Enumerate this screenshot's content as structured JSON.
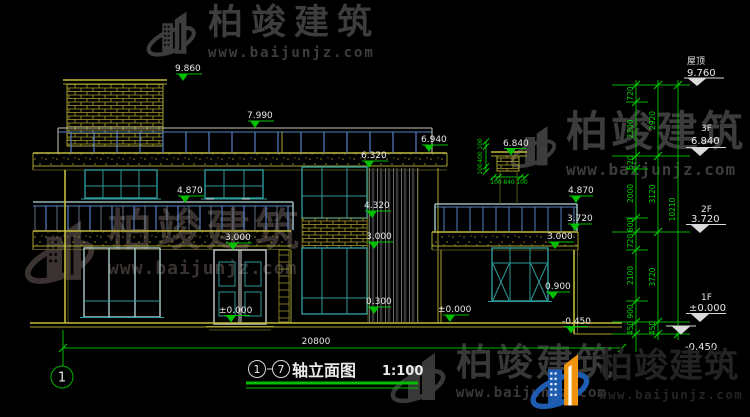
{
  "brand": {
    "name": "柏竣建筑",
    "url": "www.baijunjz.com"
  },
  "title": {
    "bubble_left": "1",
    "bubble_right": "7",
    "name": "轴立面图",
    "scale": "1:100"
  },
  "axis": {
    "bubble": "1"
  },
  "dims": {
    "v9860": "9.860",
    "v7990": "7.990",
    "v6940": "6.940",
    "v6320": "6.320",
    "v6840": "6.840",
    "v4870": "4.870",
    "v4320": "4.320",
    "v3720": "3.720",
    "v3000": "3.000",
    "v0900": "0.900",
    "v0300": "0.300",
    "vzero": "±0.000",
    "vneg": "-0.450",
    "total": "20800",
    "chimney_v": [
      "100",
      "400",
      "100"
    ],
    "chimney_h": [
      "100",
      "840",
      "100"
    ]
  },
  "levels": {
    "floors": [
      {
        "label": "屋顶",
        "value": "9.760"
      },
      {
        "label": "3F",
        "value": "6.840"
      },
      {
        "label": "2F",
        "value": "3.720"
      },
      {
        "label": "1F",
        "value": "±0.000"
      }
    ],
    "base": "-0.450",
    "chain_inner": [
      "720",
      "2200",
      "520",
      "2000",
      "600",
      "720",
      "2100",
      "900",
      "450"
    ],
    "chain_mid": [
      "2920",
      "3120",
      "3720",
      "450"
    ],
    "chain_total": "10210"
  }
}
